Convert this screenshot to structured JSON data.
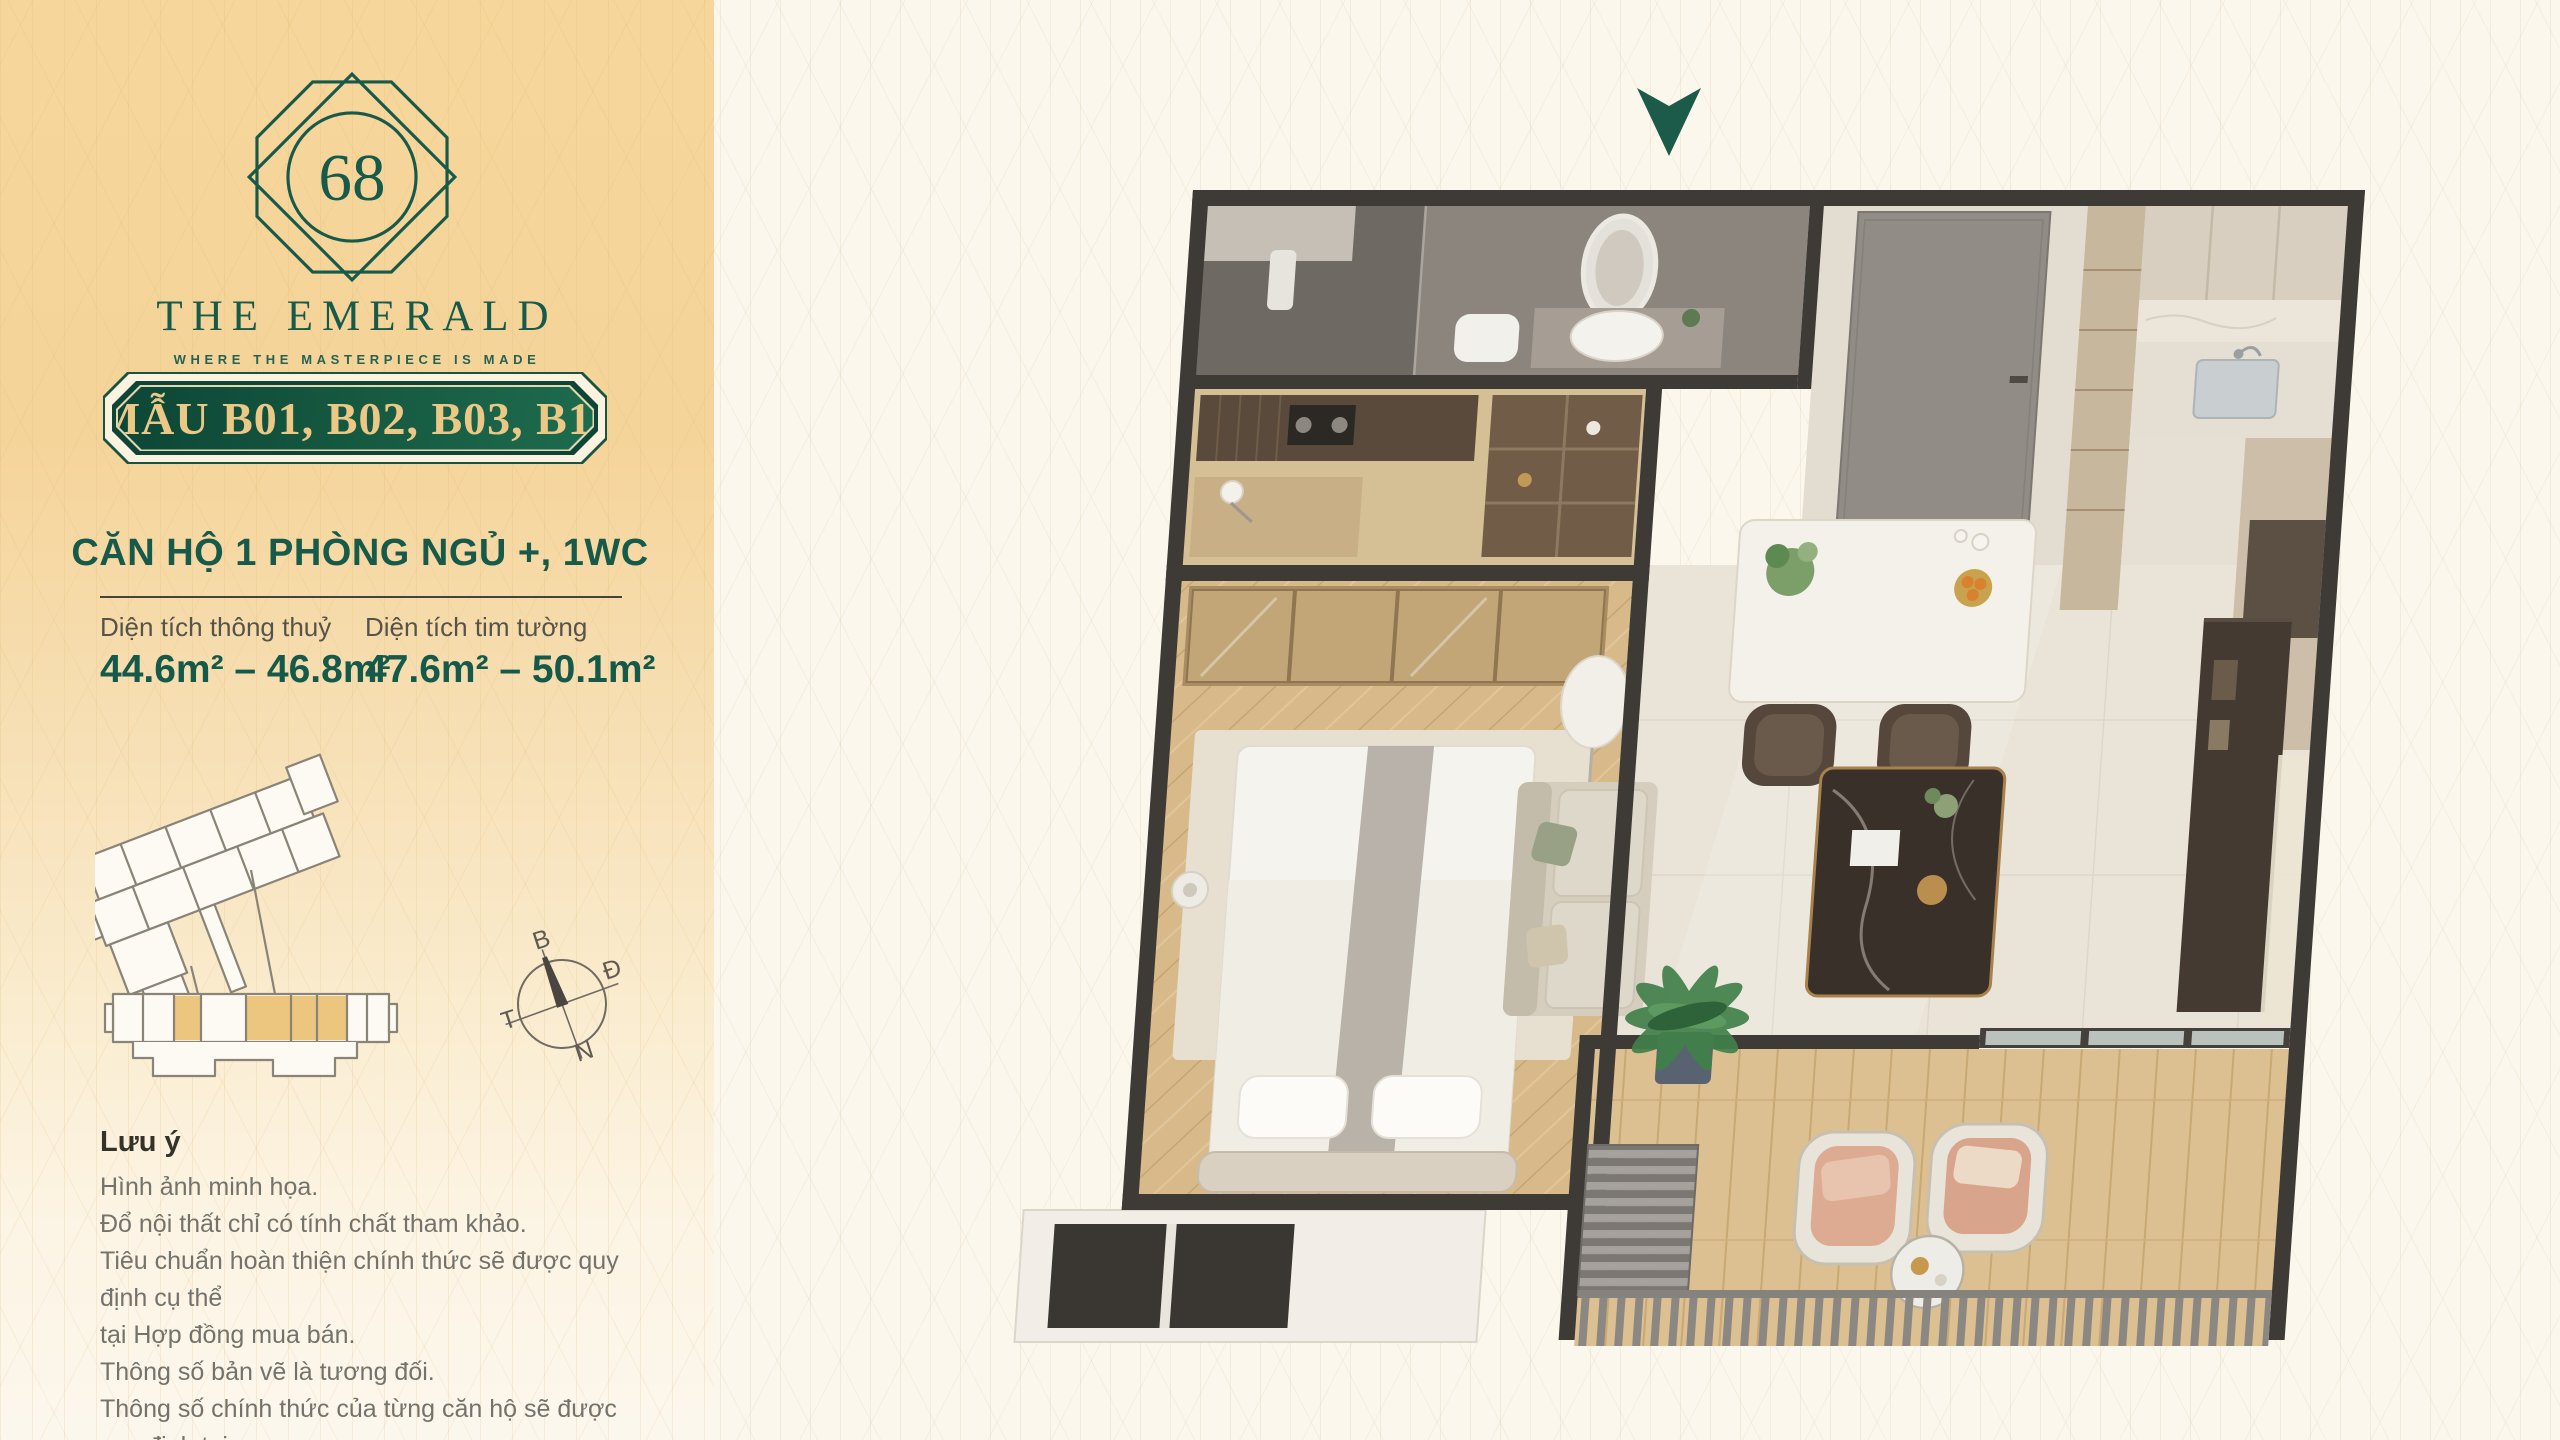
{
  "brand": {
    "number": "68",
    "name": "THE EMERALD",
    "tagline": "WHERE THE MASTERPIECE IS MADE"
  },
  "badge": {
    "label": "MẪU B01, B02, B03, B11"
  },
  "unit": {
    "title": "CĂN HỘ 1 PHÒNG NGỦ +, 1WC",
    "areas": [
      {
        "label": "Diện tích thông thuỷ",
        "value": "44.6m² – 46.8m²"
      },
      {
        "label": "Diện tích tim tường",
        "value": "47.6m² – 50.1m²"
      }
    ]
  },
  "compass": {
    "north": "B",
    "east": "Đ",
    "west": "T",
    "south": "N"
  },
  "notes": {
    "title": "Lưu ý",
    "lines": [
      "Hình ảnh minh họa.",
      "Đổ nội thất chỉ có tính chất tham khảo.",
      "Tiêu chuẩn hoàn thiện chính thức sẽ được quy định cụ thể",
      "tại Hợp đồng mua bán.",
      "Thông số bản vẽ là tương đối.",
      "Thông số chính thức của từng căn hộ sẽ được quy định tại",
      "văn bản kỹ kết giữa Chủ đầu tư & khách hàng."
    ]
  },
  "floor_plan": {
    "entrance_marker": "down-arrow-icon",
    "rooms": [
      "bathroom",
      "entry",
      "kitchen",
      "study-nook",
      "bedroom",
      "living-dining",
      "balcony"
    ]
  },
  "colors": {
    "emerald": "#175a49",
    "badge_green_dark": "#0d4637",
    "badge_green_light": "#1e6b4e",
    "gold_text": "#ecc887",
    "sidebar_yellow": "#f6d69b",
    "page_cream": "#fcf7ed",
    "wall": "#3e3a36",
    "site_highlight": "#ecc57e"
  }
}
